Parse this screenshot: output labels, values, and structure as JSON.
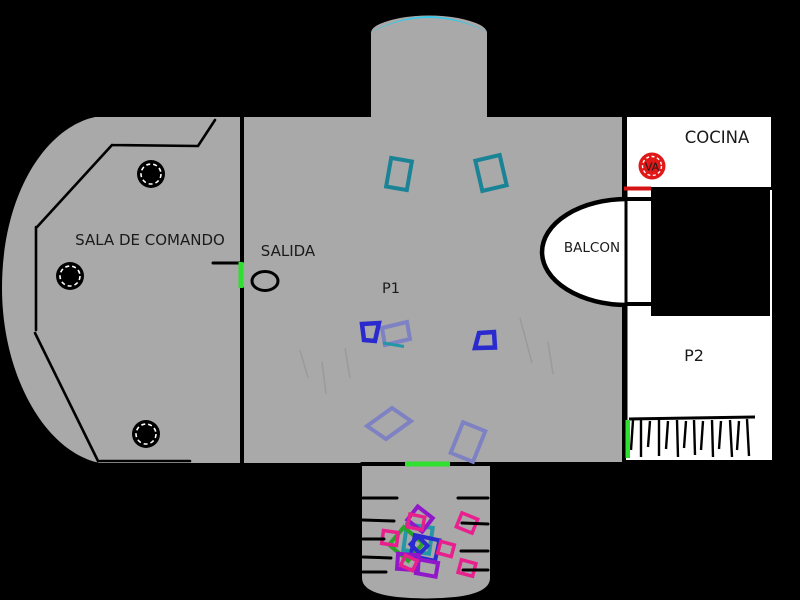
{
  "page": {
    "title": "Ship floor plan drawing"
  },
  "colors": {
    "background": "#000000",
    "floor_gray": "#a9a9a9",
    "wall_black": "#000000",
    "room_white": "#ffffff",
    "dome_cyan": "#38c8e8",
    "door_green": "#30e030",
    "door_red": "#d41414",
    "valve_red": "#e01818",
    "teal": "#1a8396",
    "teal_light": "#2397a6",
    "slate_blue": "#7e82c3",
    "blue": "#2a2ace",
    "purple": "#9018c8",
    "magenta": "#e81f8c",
    "green": "#2aa32a"
  },
  "labels": {
    "sala_de_comando": "SALA DE COMANDO",
    "salida": "SALIDA",
    "p1": "P1",
    "balcon": "BALCON",
    "cocina": "COCINA",
    "p2": "P2",
    "va": "VA"
  }
}
